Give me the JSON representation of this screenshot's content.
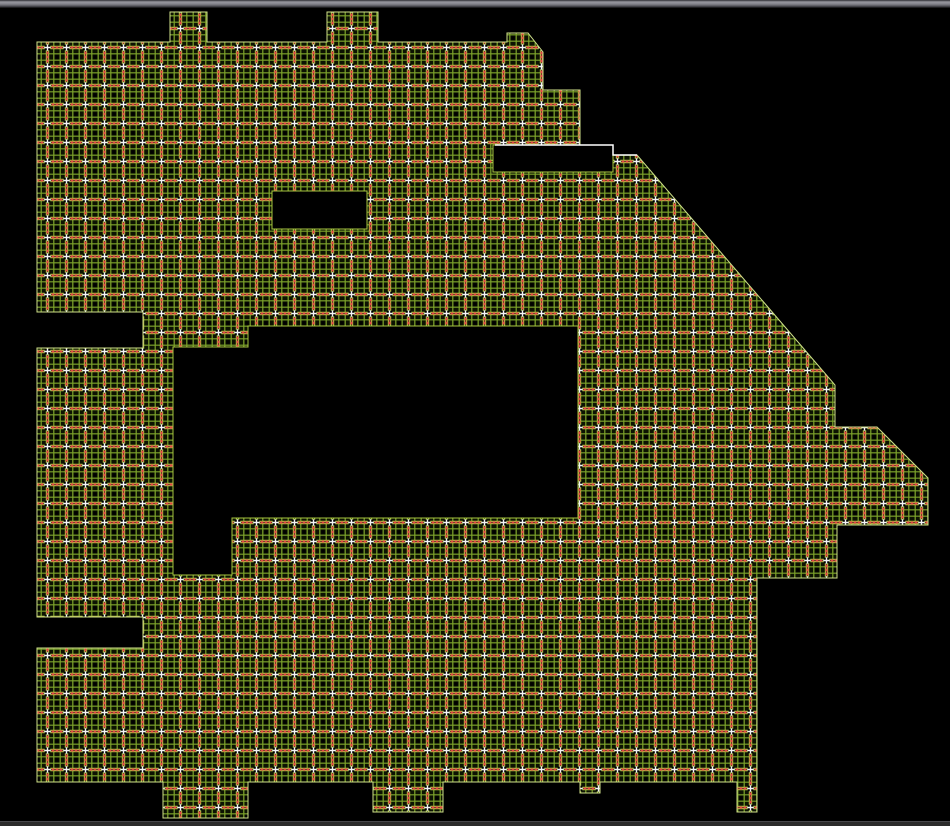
{
  "window": {
    "top_bar": {
      "height": 8,
      "gradient": [
        "#2e2e33",
        "#97979f",
        "#85858d",
        "#55555c",
        "#0b0b0b"
      ]
    },
    "bottom_bar": {
      "height": 4,
      "color": "#2b2b2b",
      "border_top": "#47474b"
    },
    "canvas_background": "#000000",
    "canvas_width": 950,
    "canvas_height": 826
  },
  "drawing": {
    "kind": "ceiling-grid-floor-plan",
    "grid_pattern": {
      "cell_size": 19,
      "background": "#0d1302",
      "fine_line_color": "#7da32b",
      "fine_line_width": 1.2,
      "major_line_color": "#a9c83f",
      "major_line_width": 3.4,
      "major_core_color": "#24300a",
      "red_mark_color": "#e04545",
      "node_color": "#000000",
      "cross_color": "#f5f5f5",
      "edge_color": "#cfe08a"
    },
    "outline_points": [
      [
        37,
        42
      ],
      [
        170,
        42
      ],
      [
        170,
        12
      ],
      [
        207,
        12
      ],
      [
        207,
        42
      ],
      [
        327,
        42
      ],
      [
        327,
        12
      ],
      [
        378,
        12
      ],
      [
        378,
        42
      ],
      [
        507,
        42
      ],
      [
        507,
        33
      ],
      [
        528,
        33
      ],
      [
        543,
        52
      ],
      [
        543,
        90
      ],
      [
        580,
        90
      ],
      [
        580,
        145
      ],
      [
        613,
        145
      ],
      [
        613,
        155
      ],
      [
        637,
        155
      ],
      [
        835,
        385
      ],
      [
        835,
        427
      ],
      [
        877,
        427
      ],
      [
        928,
        478
      ],
      [
        928,
        525
      ],
      [
        837,
        525
      ],
      [
        837,
        578
      ],
      [
        757,
        578
      ],
      [
        757,
        812
      ],
      [
        737,
        812
      ],
      [
        737,
        782
      ],
      [
        600,
        782
      ],
      [
        600,
        793
      ],
      [
        580,
        793
      ],
      [
        580,
        782
      ],
      [
        443,
        782
      ],
      [
        443,
        812
      ],
      [
        373,
        812
      ],
      [
        373,
        782
      ],
      [
        248,
        782
      ],
      [
        248,
        818
      ],
      [
        163,
        818
      ],
      [
        163,
        782
      ],
      [
        37,
        782
      ],
      [
        37,
        648
      ],
      [
        143,
        648
      ],
      [
        143,
        617
      ],
      [
        37,
        617
      ],
      [
        37,
        348
      ],
      [
        143,
        348
      ],
      [
        143,
        312
      ],
      [
        37,
        312
      ]
    ],
    "cutouts": [
      {
        "name": "small-upper-opening",
        "type": "rect",
        "x": 272,
        "y": 191,
        "w": 95,
        "h": 38
      },
      {
        "name": "top-right-notch",
        "type": "rect",
        "x": 493,
        "y": 145,
        "w": 120,
        "h": 27
      },
      {
        "name": "central-opening",
        "type": "polygon",
        "points": [
          [
            173,
            347
          ],
          [
            248,
            347
          ],
          [
            248,
            326
          ],
          [
            578,
            326
          ],
          [
            578,
            518
          ],
          [
            232,
            518
          ],
          [
            232,
            575
          ],
          [
            173,
            575
          ]
        ]
      }
    ],
    "cutout_fill": "#000000",
    "cutout_edge_color": "#a6c53f",
    "highlight_line": {
      "points": [
        [
          495,
          145
        ],
        [
          613,
          145
        ],
        [
          613,
          155
        ],
        [
          637,
          155
        ]
      ],
      "color": "#ffffff",
      "width": 1.5
    }
  }
}
